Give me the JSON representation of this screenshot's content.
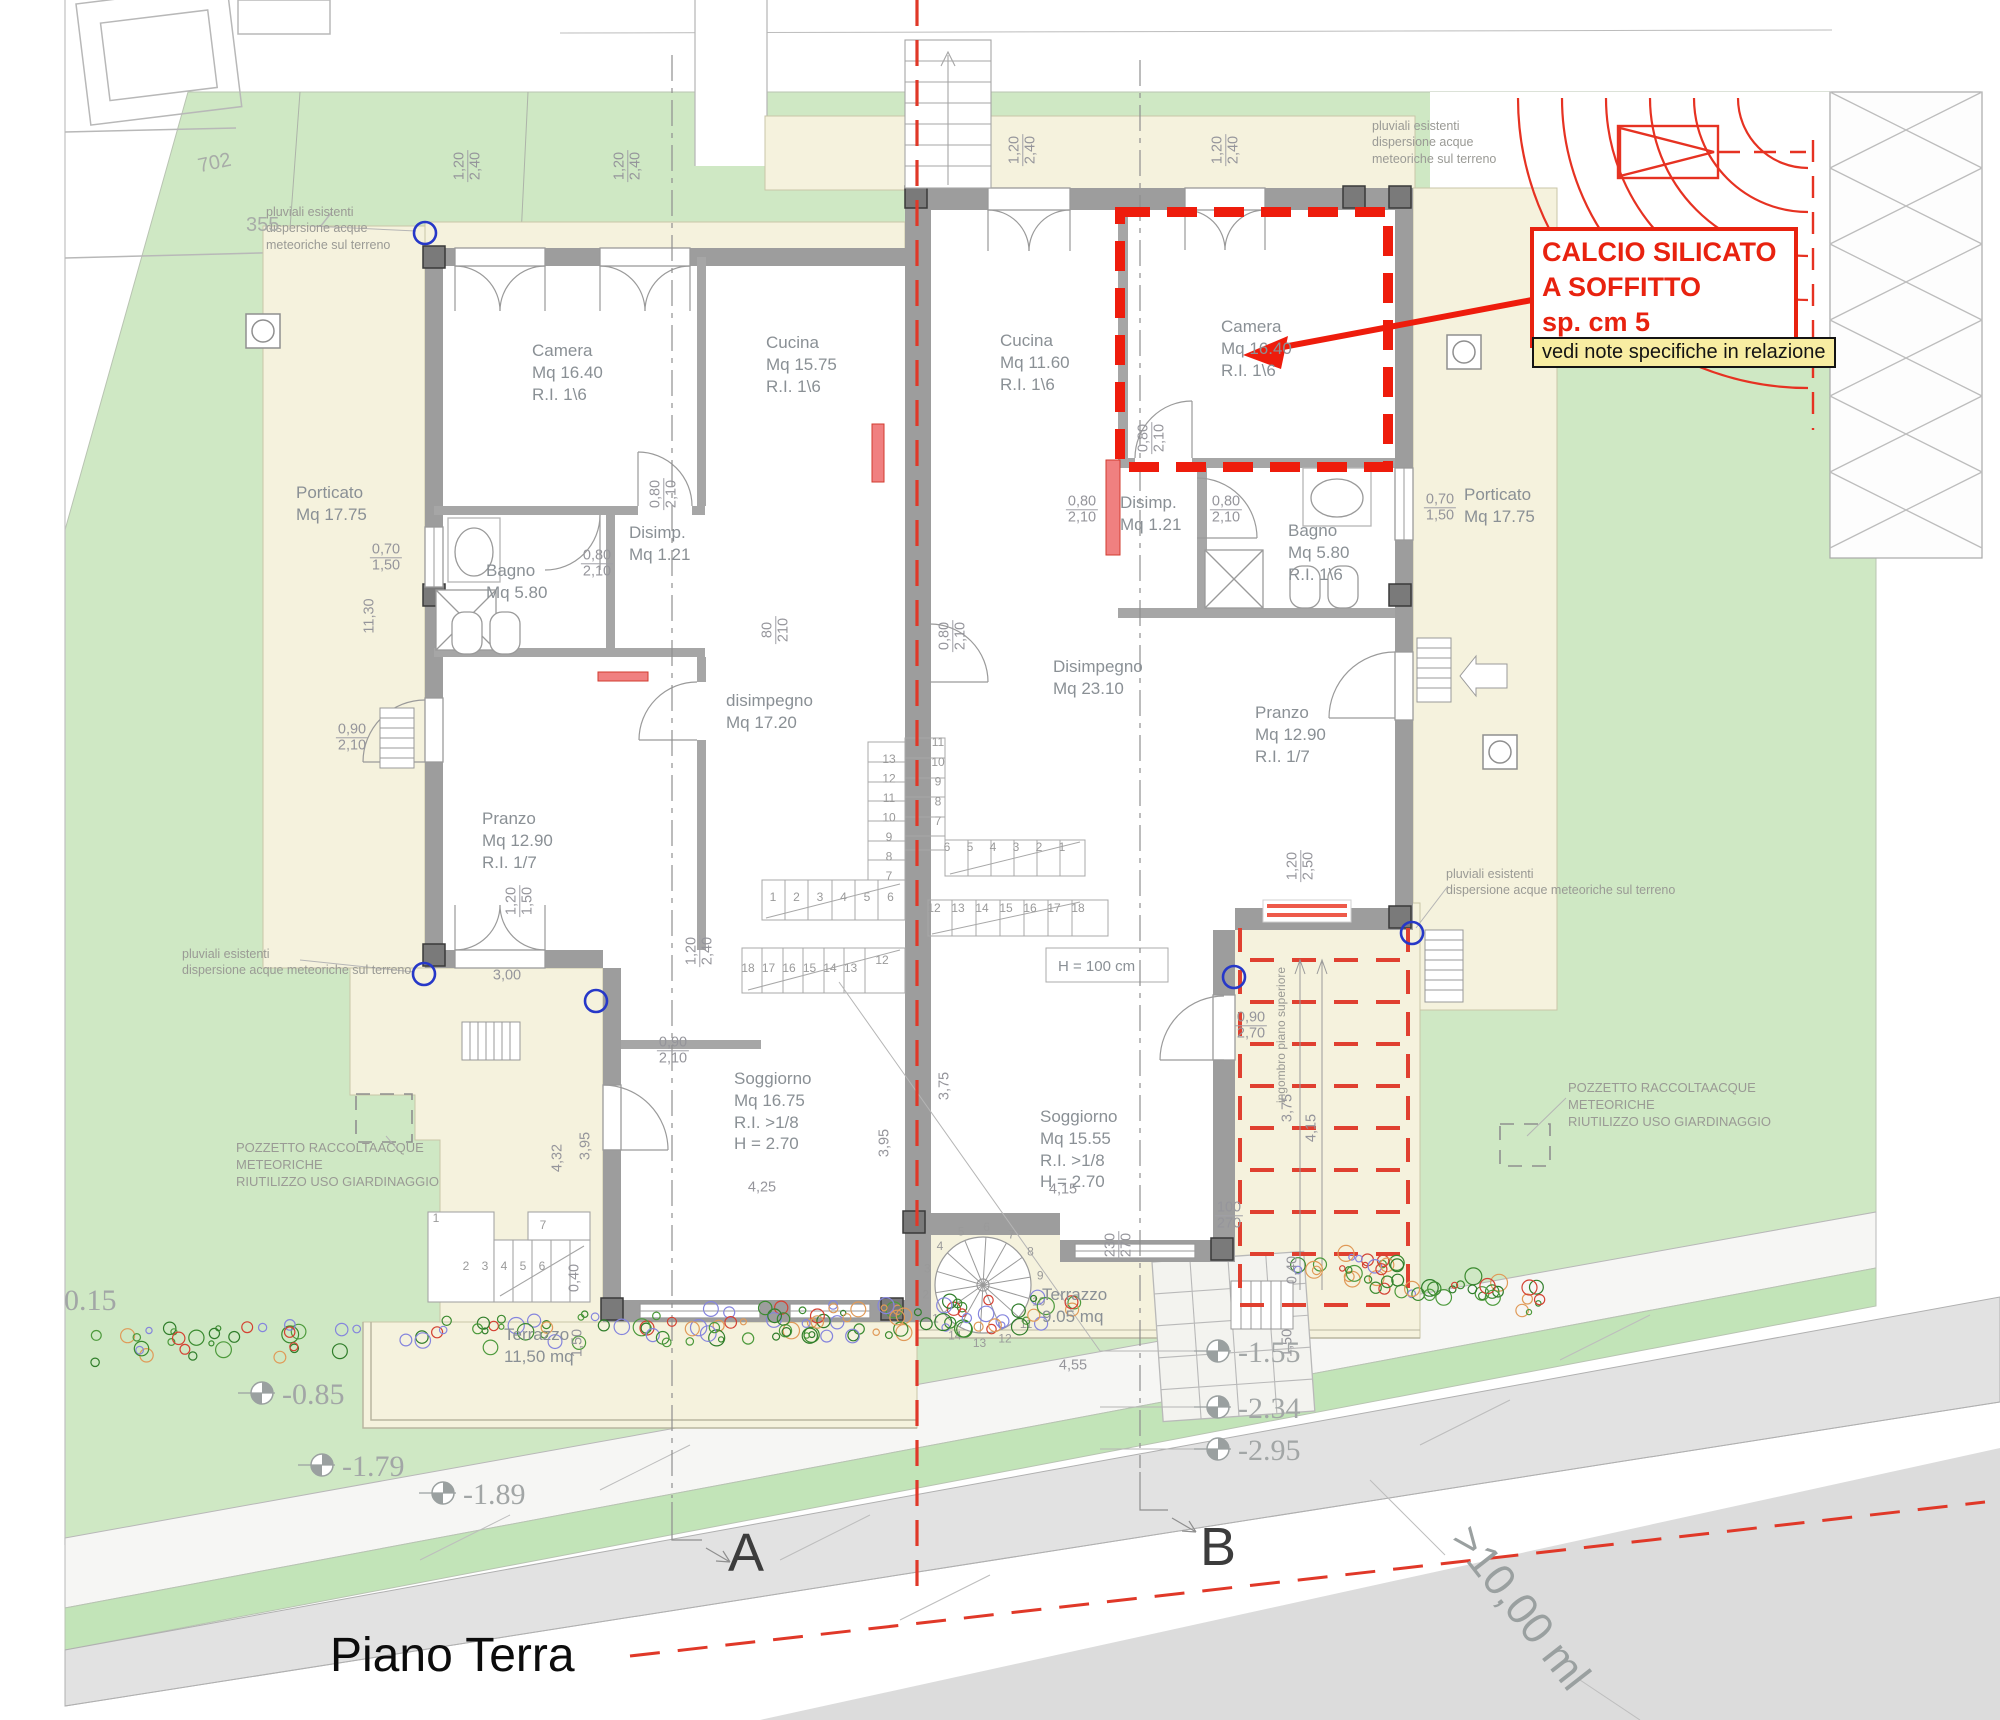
{
  "title": "Piano Terra",
  "annotation": {
    "calcio_lines": [
      "CALCIO SILICATO",
      "A SOFFITTO",
      "sp. cm 5"
    ],
    "note_text": "vedi note specifiche in relazione"
  },
  "sections": {
    "a": "A",
    "b": "B"
  },
  "road_dim": ">10,00 ml",
  "parcels": [
    {
      "t": "702",
      "x": 198,
      "y": 152,
      "r": -12
    },
    {
      "t": "355",
      "x": 246,
      "y": 214,
      "r": 0
    }
  ],
  "room_labels": [
    {
      "id": "porticato-left",
      "lines": [
        "Porticato",
        "Mq 17.75"
      ],
      "x": 296,
      "y": 482
    },
    {
      "id": "camera-left",
      "lines": [
        "Camera",
        "Mq 16.40",
        "R.I. 1\\6"
      ],
      "x": 532,
      "y": 340
    },
    {
      "id": "cucina-left",
      "lines": [
        "Cucina",
        "Mq 15.75",
        "R.I. 1\\6"
      ],
      "x": 766,
      "y": 332
    },
    {
      "id": "bagno-left",
      "lines": [
        "Bagno",
        "Mq 5.80"
      ],
      "x": 486,
      "y": 560
    },
    {
      "id": "disimp-left",
      "lines": [
        "Disimp.",
        "Mq 1.21"
      ],
      "x": 629,
      "y": 522
    },
    {
      "id": "disimpegno-left",
      "lines": [
        "disimpegno",
        "Mq 17.20"
      ],
      "x": 726,
      "y": 690
    },
    {
      "id": "pranzo-left",
      "lines": [
        "Pranzo",
        "Mq 12.90",
        "R.I. 1/7"
      ],
      "x": 482,
      "y": 808
    },
    {
      "id": "soggiorno-left",
      "lines": [
        "Soggiorno",
        "Mq 16.75",
        "R.I. >1/8",
        "H = 2.70"
      ],
      "x": 734,
      "y": 1068
    },
    {
      "id": "terrazzo-left",
      "lines": [
        "Terrazzo",
        "11,50 mq"
      ],
      "x": 504,
      "y": 1324
    },
    {
      "id": "cucina-right",
      "lines": [
        "Cucina",
        "Mq 11.60",
        "R.I. 1\\6"
      ],
      "x": 1000,
      "y": 330
    },
    {
      "id": "camera-right",
      "lines": [
        "Camera",
        "Mq 16.40",
        "R.I. 1\\6"
      ],
      "x": 1221,
      "y": 316
    },
    {
      "id": "disimp-right",
      "lines": [
        "Disimp.",
        "Mq 1.21"
      ],
      "x": 1120,
      "y": 492
    },
    {
      "id": "bagno-right",
      "lines": [
        "Bagno",
        "Mq 5.80",
        "R.I. 1\\6"
      ],
      "x": 1288,
      "y": 520
    },
    {
      "id": "disimpegno-right",
      "lines": [
        "Disimpegno",
        "Mq 23.10"
      ],
      "x": 1053,
      "y": 656
    },
    {
      "id": "pranzo-right",
      "lines": [
        "Pranzo",
        "Mq 12.90",
        "R.I. 1/7"
      ],
      "x": 1255,
      "y": 702
    },
    {
      "id": "soggiorno-right",
      "lines": [
        "Soggiorno",
        "Mq 15.55",
        "R.I. >1/8",
        "H = 2.70"
      ],
      "x": 1040,
      "y": 1106
    },
    {
      "id": "terrazzo-right",
      "lines": [
        "Terrazzo",
        "9.05 mq"
      ],
      "x": 1042,
      "y": 1284
    },
    {
      "id": "porticato-right",
      "lines": [
        "Porticato",
        "Mq 17.75"
      ],
      "x": 1464,
      "y": 484
    },
    {
      "id": "stair-height",
      "lines": [
        "H = 100 cm"
      ],
      "x": 1058,
      "y": 957,
      "size": 15
    }
  ],
  "notes": [
    {
      "id": "pluviali-top-left",
      "lines": [
        "pluviali esistenti",
        "dispersione acque",
        "meteoriche sul terreno"
      ],
      "x": 266,
      "y": 204
    },
    {
      "id": "pluviali-top-right",
      "lines": [
        "pluviali esistenti",
        "dispersione acque",
        "meteoriche sul terreno"
      ],
      "x": 1372,
      "y": 118
    },
    {
      "id": "pluviali-right",
      "lines": [
        "pluviali esistenti",
        "dispersione acque meteoriche sul terreno"
      ],
      "x": 1446,
      "y": 866
    },
    {
      "id": "pluviali-bottom-left",
      "lines": [
        "pluviali esistenti",
        "dispersione acque meteoriche sul terreno"
      ],
      "x": 182,
      "y": 946
    },
    {
      "id": "pozzetto-left",
      "lines": [
        "POZZETTO RACCOLTAACQUE",
        "METEORICHE",
        "RIUTILIZZO USO GIARDINAGGIO"
      ],
      "x": 236,
      "y": 1140,
      "size": 13
    },
    {
      "id": "pozzetto-right",
      "lines": [
        "POZZETTO RACCOLTAACQUE",
        "METEORICHE",
        "RIUTILIZZO USO GIARDINAGGIO"
      ],
      "x": 1568,
      "y": 1080,
      "size": 13
    },
    {
      "id": "ingombro",
      "lines": [
        "ingombro piano superiore"
      ],
      "x": 1282,
      "y": 1035,
      "size": 12,
      "r": -90
    }
  ],
  "dims": [
    {
      "t": [
        "1,20",
        "2,40"
      ],
      "x": 468,
      "y": 166,
      "r": -90
    },
    {
      "t": [
        "1,20",
        "2,40"
      ],
      "x": 628,
      "y": 166,
      "r": -90
    },
    {
      "t": [
        "1,20",
        "2,40"
      ],
      "x": 1023,
      "y": 150,
      "r": -90
    },
    {
      "t": [
        "1,20",
        "2,40"
      ],
      "x": 1226,
      "y": 150,
      "r": -90
    },
    {
      "t": [
        "0,70",
        "1,50"
      ],
      "x": 386,
      "y": 558,
      "r": 0
    },
    {
      "t": [
        "11,30"
      ],
      "x": 370,
      "y": 616,
      "r": -90
    },
    {
      "t": [
        "0,80",
        "2,10"
      ],
      "x": 664,
      "y": 494,
      "r": -90
    },
    {
      "t": [
        "0,80",
        "2,10"
      ],
      "x": 597,
      "y": 564,
      "r": 0
    },
    {
      "t": [
        "80",
        "210"
      ],
      "x": 776,
      "y": 630,
      "r": -90
    },
    {
      "t": [
        "0,80",
        "2,10"
      ],
      "x": 953,
      "y": 636,
      "r": -90
    },
    {
      "t": [
        "0,80",
        "2,10"
      ],
      "x": 1152,
      "y": 438,
      "r": -90
    },
    {
      "t": [
        "0,80",
        "2,10"
      ],
      "x": 1082,
      "y": 510,
      "r": 0
    },
    {
      "t": [
        "0,80",
        "2,10"
      ],
      "x": 1226,
      "y": 510,
      "r": 0
    },
    {
      "t": [
        "0,70",
        "1,50"
      ],
      "x": 1440,
      "y": 508,
      "r": 0
    },
    {
      "t": [
        "0,90",
        "2,10"
      ],
      "x": 352,
      "y": 738,
      "r": 0
    },
    {
      "t": [
        "1,20",
        "1,50"
      ],
      "x": 520,
      "y": 901,
      "r": -90
    },
    {
      "t": [
        "3,00"
      ],
      "x": 507,
      "y": 976,
      "r": 0
    },
    {
      "t": [
        "1,20",
        "2,40"
      ],
      "x": 700,
      "y": 951,
      "r": -90
    },
    {
      "t": [
        "0,90",
        "2,10"
      ],
      "x": 673,
      "y": 1051,
      "r": 0
    },
    {
      "t": [
        "0,90",
        "2,70"
      ],
      "x": 1251,
      "y": 1026,
      "r": 0
    },
    {
      "t": [
        "1,20",
        "2,50"
      ],
      "x": 1301,
      "y": 866,
      "r": -90
    },
    {
      "t": [
        "3,75"
      ],
      "x": 945,
      "y": 1086,
      "r": -90
    },
    {
      "t": [
        "3,95"
      ],
      "x": 885,
      "y": 1143,
      "r": -90
    },
    {
      "t": [
        "4,25"
      ],
      "x": 762,
      "y": 1188,
      "r": 0
    },
    {
      "t": [
        "4,15"
      ],
      "x": 1063,
      "y": 1190,
      "r": 0
    },
    {
      "t": [
        "4,55"
      ],
      "x": 1073,
      "y": 1366,
      "r": 0
    },
    {
      "t": [
        "230",
        "270"
      ],
      "x": 1119,
      "y": 1245,
      "r": -90
    },
    {
      "t": [
        "0,40"
      ],
      "x": 575,
      "y": 1278,
      "r": -90
    },
    {
      "t": [
        "1,50"
      ],
      "x": 578,
      "y": 1343,
      "r": -90
    },
    {
      "t": [
        "4,32"
      ],
      "x": 558,
      "y": 1158,
      "r": -90
    },
    {
      "t": [
        "3,95"
      ],
      "x": 586,
      "y": 1146,
      "r": -90
    },
    {
      "t": [
        "100",
        "270"
      ],
      "x": 1229,
      "y": 1216,
      "r": 0
    },
    {
      "t": [
        "4,15"
      ],
      "x": 1312,
      "y": 1128,
      "r": -90
    },
    {
      "t": [
        "3,75"
      ],
      "x": 1288,
      "y": 1108,
      "r": -90
    },
    {
      "t": [
        "0,40"
      ],
      "x": 1293,
      "y": 1270,
      "r": -90
    },
    {
      "t": [
        "1,50"
      ],
      "x": 1288,
      "y": 1343,
      "r": -90
    }
  ],
  "elevations": [
    {
      "t": "0.15",
      "x": 64,
      "y": 1284,
      "sym": 0
    },
    {
      "t": "-0.85",
      "x": 282,
      "y": 1378,
      "sx": 262,
      "sy": 1393,
      "sym": 1
    },
    {
      "t": "-1.79",
      "x": 342,
      "y": 1450,
      "sx": 322,
      "sy": 1465,
      "sym": 1
    },
    {
      "t": "-1.89",
      "x": 463,
      "y": 1478,
      "sx": 443,
      "sy": 1493,
      "sym": 1
    },
    {
      "t": "-1.55",
      "x": 1238,
      "y": 1336,
      "sx": 1218,
      "sy": 1351,
      "sym": 1
    },
    {
      "t": "-2.34",
      "x": 1238,
      "y": 1392,
      "sx": 1218,
      "sy": 1407,
      "sym": 1
    },
    {
      "t": "-2.95",
      "x": 1238,
      "y": 1434,
      "sx": 1218,
      "sy": 1449,
      "sym": 1
    }
  ],
  "stair_runs": [
    {
      "n": [
        "1",
        "2",
        "3",
        "4",
        "5",
        "6"
      ],
      "x": 773,
      "y": 901,
      "dx": 23.5,
      "dy": 0
    },
    {
      "n": [
        "7",
        "8",
        "9",
        "10",
        "11",
        "12",
        "13"
      ],
      "x": 889,
      "y": 880,
      "dx": 0,
      "dy": -19.5
    },
    {
      "n": [
        "18",
        "17",
        "16",
        "15",
        "14",
        "13"
      ],
      "x": 748,
      "y": 972,
      "dx": 20.5,
      "dy": 0
    },
    {
      "n": [
        "12"
      ],
      "x": 882,
      "y": 964,
      "dx": 0,
      "dy": 0
    },
    {
      "n": [
        "11",
        "10",
        "9",
        "8",
        "7"
      ],
      "x": 938,
      "y": 746,
      "dx": 0,
      "dy": 19.8
    },
    {
      "n": [
        "6",
        "5",
        "4",
        "3",
        "2",
        "1"
      ],
      "x": 947,
      "y": 851,
      "dx": 23,
      "dy": 0
    },
    {
      "n": [
        "12",
        "13",
        "14",
        "15",
        "16",
        "17",
        "18"
      ],
      "x": 934,
      "y": 912,
      "dx": 24,
      "dy": 0
    },
    {
      "n": [
        "1"
      ],
      "x": 436,
      "y": 1222,
      "dx": 0,
      "dy": 0
    },
    {
      "n": [
        "2",
        "3",
        "4",
        "5",
        "6"
      ],
      "x": 466,
      "y": 1270,
      "dx": 19,
      "dy": 0
    },
    {
      "n": [
        "7"
      ],
      "x": 543,
      "y": 1229,
      "dx": 0,
      "dy": 0
    }
  ],
  "spiral": {
    "cx": 983,
    "cy": 1285,
    "rn": 58,
    "nums": [
      "1",
      "2",
      "3",
      "4",
      "5",
      "6",
      "7",
      "8",
      "9",
      "10",
      "11",
      "12",
      "13",
      "14"
    ],
    "a0": 215,
    "da": -25.7
  },
  "blue_points": [
    [
      425,
      233
    ],
    [
      424,
      974
    ],
    [
      596,
      1001
    ],
    [
      1234,
      977
    ],
    [
      1412,
      933
    ]
  ],
  "hedges": [
    {
      "x0": 95,
      "y0": 1348,
      "x1": 1078,
      "y1": 1312,
      "n": 150,
      "seed": 7
    },
    {
      "x0": 1298,
      "y0": 1258,
      "x1": 1540,
      "y1": 1302,
      "n": 55,
      "seed": 13
    }
  ]
}
